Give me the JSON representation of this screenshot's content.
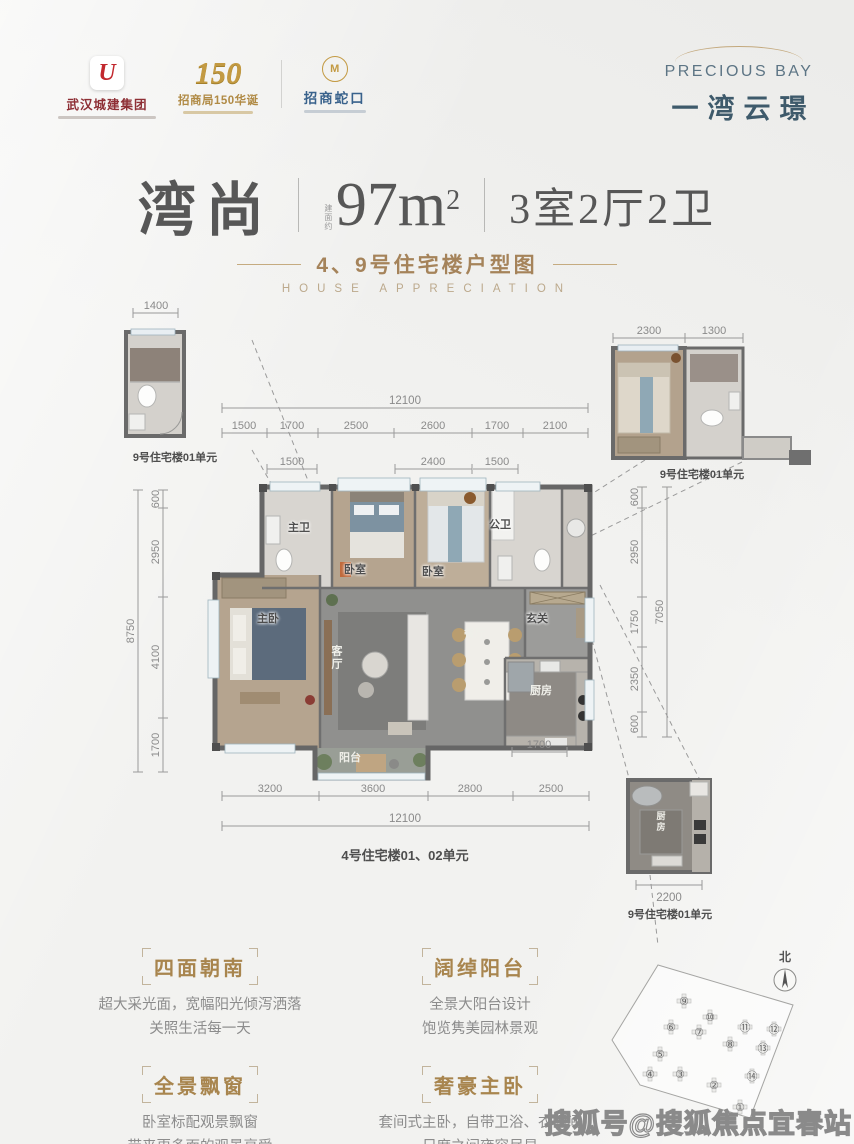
{
  "header": {
    "logos": [
      {
        "mark": "U",
        "name": "武汉城建集团"
      },
      {
        "num": "150",
        "name": "招商局150华诞"
      },
      {
        "mark": "M",
        "name": "招商蛇口"
      }
    ],
    "brand": {
      "en": "PRECIOUS BAY",
      "cn": "一湾云璟"
    }
  },
  "title": {
    "name": "湾尚",
    "area_note": "建面约",
    "area": "97m",
    "area_sup": "2",
    "rooms": "3室2厅2卫",
    "subtitle_cn": "4、9号住宅楼户型图",
    "subtitle_en": "HOUSE APPRECIATION"
  },
  "plan": {
    "labels": {
      "master_bath": "主卫",
      "bed1": "卧室",
      "bed2": "卧室",
      "public_bath": "公卫",
      "master": "主卧",
      "living": "客厅",
      "dining": "餐厅",
      "entry": "玄关",
      "kitchen": "厨房",
      "balcony": "阳台"
    },
    "unit_label_main": "4号住宅楼01、02单元",
    "details": {
      "top_left": {
        "dim": "1400",
        "label": "9号住宅楼01单元"
      },
      "top_right": {
        "dim_a": "2300",
        "dim_b": "1300",
        "label": "9号住宅楼01单元"
      },
      "bottom_right": {
        "dim": "2200",
        "room": "厨房",
        "label": "9号住宅楼01单元"
      }
    },
    "dims": {
      "top_total": "12100",
      "top": [
        "1500",
        "1700",
        "2500",
        "2600",
        "1700",
        "2100"
      ],
      "windows": [
        "1500",
        "2400",
        "1500"
      ],
      "left": [
        "600",
        "2950",
        "4100",
        "1700"
      ],
      "left_total": "8750",
      "right": [
        "600",
        "2950",
        "1750",
        "2350",
        "600"
      ],
      "right_total": "7050",
      "bottom": [
        "3200",
        "3600",
        "2800",
        "2500"
      ],
      "bottom_total": "12100",
      "kitchen": "1700"
    }
  },
  "features": [
    {
      "title": "四面朝南",
      "line1": "超大采光面，宽幅阳光倾泻洒落",
      "line2": "关照生活每一天"
    },
    {
      "title": "阔绰阳台",
      "line1": "全景大阳台设计",
      "line2": "饱览隽美园林景观"
    },
    {
      "title": "全景飘窗",
      "line1": "卧室标配观景飘窗",
      "line2": "带来更多面的观景享受"
    },
    {
      "title": "奢豪主卧",
      "line1": "套间式主卧，自带卫浴、衣帽间",
      "line2": "尺度之间雍容尽显"
    }
  ],
  "siteplan": {
    "north": "北",
    "buildings": [
      {
        "n": "①",
        "x": 135,
        "y": 172
      },
      {
        "n": "②",
        "x": 109,
        "y": 150
      },
      {
        "n": "③",
        "x": 75,
        "y": 139
      },
      {
        "n": "④",
        "x": 45,
        "y": 139
      },
      {
        "n": "⑤",
        "x": 55,
        "y": 119
      },
      {
        "n": "⑥",
        "x": 66,
        "y": 92
      },
      {
        "n": "⑦",
        "x": 94,
        "y": 97
      },
      {
        "n": "⑧",
        "x": 125,
        "y": 109
      },
      {
        "n": "⑨",
        "x": 79,
        "y": 66
      },
      {
        "n": "⑩",
        "x": 105,
        "y": 82
      },
      {
        "n": "⑪",
        "x": 140,
        "y": 92
      },
      {
        "n": "⑫",
        "x": 169,
        "y": 94
      },
      {
        "n": "⑬",
        "x": 158,
        "y": 113
      },
      {
        "n": "⑭",
        "x": 147,
        "y": 141
      }
    ]
  },
  "watermark": "搜狐号@搜狐焦点宜春站",
  "colors": {
    "accent_gold": "#a8854e",
    "brand_blue": "#3e5a6b",
    "logo_red": "#c2282e"
  }
}
